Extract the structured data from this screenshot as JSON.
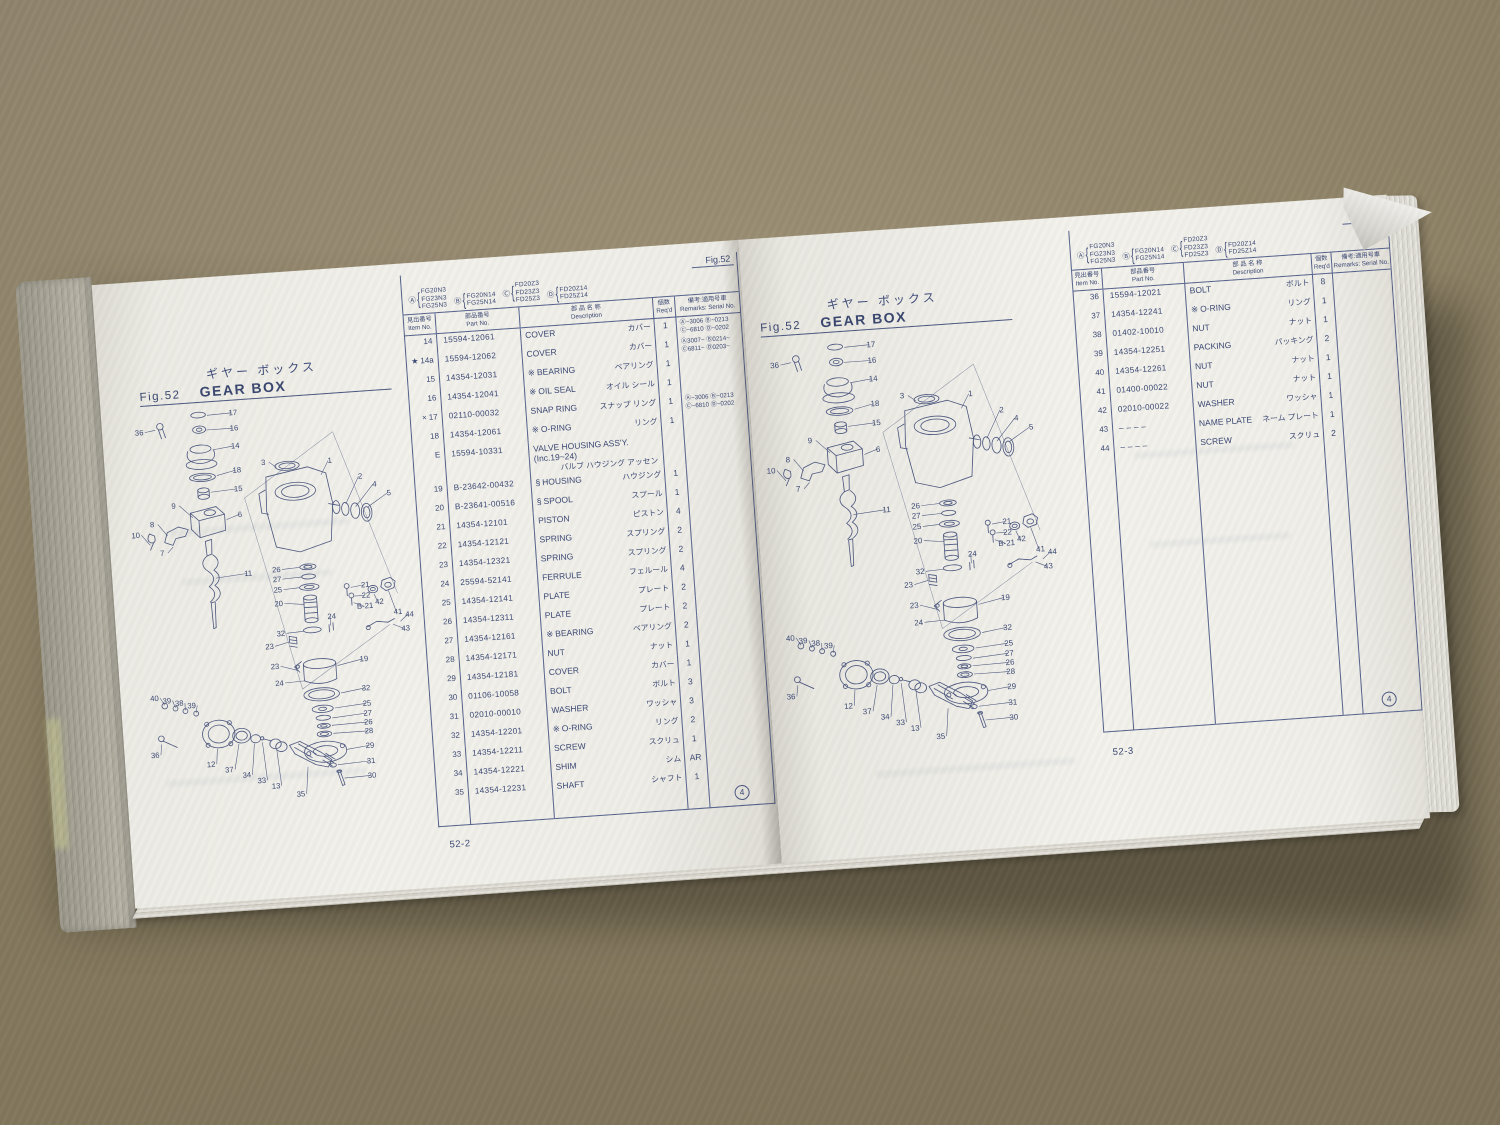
{
  "photo": {
    "surface": "cardboard",
    "cardboard_color": "#948769",
    "paper_color": "#f2f1eb",
    "ink_color": "#3b4874"
  },
  "left_page": {
    "title_jp": "ギヤー ボックス",
    "fig": "Fig.52",
    "title_en": "GEAR BOX",
    "footer": "52-2",
    "circle_mark": "4"
  },
  "right_page": {
    "title_jp": "ギヤー ボックス",
    "fig": "Fig.52",
    "title_en": "GEAR BOX",
    "footer": "52-3",
    "circle_mark": "4"
  },
  "table_header": {
    "fig_label": "Fig.52",
    "model_groups": [
      {
        "tag": "Ⓐ",
        "models": [
          "FG20N3",
          "FG23N3",
          "FG25N3"
        ]
      },
      {
        "tag": "Ⓑ",
        "models": [
          "FG20N14",
          "FG25N14"
        ]
      },
      {
        "tag": "Ⓒ",
        "models": [
          "FD20Z3",
          "FD23Z3",
          "FD25Z3"
        ]
      },
      {
        "tag": "Ⓓ",
        "models": [
          "FD20Z14",
          "FD25Z14"
        ]
      }
    ],
    "columns": [
      {
        "jp": "見出番号",
        "en": "Item No."
      },
      {
        "jp": "部品番号",
        "en": "Part No."
      },
      {
        "jp": "部 品 名 称",
        "en": "Description"
      },
      {
        "jp": "個数",
        "en": "Req'd"
      },
      {
        "jp": "備考:適用号車",
        "en": "Remarks: Serial No."
      }
    ]
  },
  "left_rows": [
    {
      "item": "14",
      "part": "15594-12061",
      "desc": "COVER",
      "kana": "カバー",
      "qty": "1",
      "rem": [
        "Ⓐ~3006 Ⓑ~0213",
        "Ⓒ~6810 Ⓓ~0202"
      ]
    },
    {
      "imark": "★",
      "item": "14a",
      "part": "15594-12062",
      "desc": "COVER",
      "kana": "カバー",
      "qty": "1",
      "rem": [
        "Ⓐ3007~ Ⓑ0214~",
        "Ⓒ6811~ Ⓓ0203~"
      ]
    },
    {
      "item": "15",
      "part": "14354-12031",
      "mark": "※",
      "desc": "BEARING",
      "kana": "ベアリング",
      "qty": "1"
    },
    {
      "item": "16",
      "part": "14354-12041",
      "mark": "※",
      "desc": "OIL SEAL",
      "kana": "オイル シール",
      "qty": "1"
    },
    {
      "imark": "×",
      "item": "17",
      "part": "02110-00032",
      "desc": "SNAP RING",
      "kana": "スナップ リング",
      "qty": "1",
      "rem": [
        "Ⓐ~3006 Ⓑ~0213",
        "Ⓒ~6810 Ⓓ~0202"
      ]
    },
    {
      "item": "18",
      "part": "14354-12061",
      "mark": "※",
      "desc": "O-RING",
      "kana": "リング",
      "qty": "1"
    },
    {
      "item": "E",
      "part": "15594-10331",
      "desc": "VALVE HOUSING ASS'Y.",
      "desc2": "(Inc.19~24)",
      "kana": "バルブ ハウジング アッセン",
      "kana_below": true,
      "qty": ""
    },
    {
      "item": "19",
      "part": "B-23642-00432",
      "mark": "§",
      "desc": "HOUSING",
      "kana": "ハウジング",
      "qty": "1"
    },
    {
      "item": "20",
      "part": "B-23641-00516",
      "mark": "§",
      "desc": "SPOOL",
      "kana": "スプール",
      "qty": "1"
    },
    {
      "item": "21",
      "part": "14354-12101",
      "desc": "PISTON",
      "kana": "ピストン",
      "qty": "4"
    },
    {
      "item": "22",
      "part": "14354-12121",
      "desc": "SPRING",
      "kana": "スプリング",
      "qty": "2"
    },
    {
      "item": "23",
      "part": "14354-12321",
      "desc": "SPRING",
      "kana": "スプリング",
      "qty": "2"
    },
    {
      "item": "24",
      "part": "25594-52141",
      "desc": "FERRULE",
      "kana": "フェルール",
      "qty": "4"
    },
    {
      "item": "25",
      "part": "14354-12141",
      "desc": "PLATE",
      "kana": "プレート",
      "qty": "2"
    },
    {
      "item": "26",
      "part": "14354-12311",
      "desc": "PLATE",
      "kana": "プレート",
      "qty": "2"
    },
    {
      "item": "27",
      "part": "14354-12161",
      "mark": "※",
      "desc": "BEARING",
      "kana": "ベアリング",
      "qty": "2"
    },
    {
      "item": "28",
      "part": "14354-12171",
      "desc": "NUT",
      "kana": "ナット",
      "qty": "1"
    },
    {
      "item": "29",
      "part": "14354-12181",
      "desc": "COVER",
      "kana": "カバー",
      "qty": "1"
    },
    {
      "item": "30",
      "part": "01106-10058",
      "desc": "BOLT",
      "kana": "ボルト",
      "qty": "3"
    },
    {
      "item": "31",
      "part": "02010-00010",
      "desc": "WASHER",
      "kana": "ワッシャ",
      "qty": "3"
    },
    {
      "item": "32",
      "part": "14354-12201",
      "mark": "※",
      "desc": "O-RING",
      "kana": "リング",
      "qty": "2"
    },
    {
      "item": "33",
      "part": "14354-12211",
      "desc": "SCREW",
      "kana": "スクリュ",
      "qty": "1"
    },
    {
      "item": "34",
      "part": "14354-12221",
      "desc": "SHIM",
      "kana": "シム",
      "qty": "AR"
    },
    {
      "item": "35",
      "part": "14354-12231",
      "desc": "SHAFT",
      "kana": "シャフト",
      "qty": "1"
    }
  ],
  "right_rows": [
    {
      "item": "36",
      "part": "15594-12021",
      "desc": "BOLT",
      "kana": "ボルト",
      "qty": "8"
    },
    {
      "item": "37",
      "part": "14354-12241",
      "mark": "※",
      "desc": "O-RING",
      "kana": "リング",
      "qty": "1"
    },
    {
      "item": "38",
      "part": "01402-10010",
      "desc": "NUT",
      "kana": "ナット",
      "qty": "1"
    },
    {
      "item": "39",
      "part": "14354-12251",
      "desc": "PACKING",
      "kana": "パッキング",
      "qty": "2"
    },
    {
      "item": "40",
      "part": "14354-12261",
      "desc": "NUT",
      "kana": "ナット",
      "qty": "1"
    },
    {
      "item": "41",
      "part": "01400-00022",
      "desc": "NUT",
      "kana": "ナット",
      "qty": "1"
    },
    {
      "item": "42",
      "part": "02010-00022",
      "desc": "WASHER",
      "kana": "ワッシャ",
      "qty": "1"
    },
    {
      "item": "43",
      "part": "– – – –",
      "desc": "NAME PLATE",
      "kana": "ネーム プレート",
      "qty": "1"
    },
    {
      "item": "44",
      "part": "– – – –",
      "desc": "SCREW",
      "kana": "スクリュ",
      "qty": "2"
    }
  ],
  "diagram_callouts": [
    {
      "t": "36",
      "x": 26,
      "y": 46,
      "ex": 46,
      "ey": 41
    },
    {
      "t": "17",
      "x": 143,
      "y": 29,
      "ex": 111,
      "ey": 27
    },
    {
      "t": "16",
      "x": 143,
      "y": 48,
      "ex": 109,
      "ey": 45
    },
    {
      "t": "14",
      "x": 143,
      "y": 70,
      "ex": 115,
      "ey": 70
    },
    {
      "t": "18",
      "x": 143,
      "y": 100,
      "ex": 118,
      "ey": 102
    },
    {
      "t": "15",
      "x": 143,
      "y": 123,
      "ex": 109,
      "ey": 122
    },
    {
      "t": "6",
      "x": 143,
      "y": 155,
      "ex": 126,
      "ey": 157
    },
    {
      "t": "9",
      "x": 62,
      "y": 139,
      "ex": 85,
      "ey": 152
    },
    {
      "t": "8",
      "x": 34,
      "y": 160,
      "ex": 52,
      "ey": 172
    },
    {
      "t": "10",
      "x": 13,
      "y": 172,
      "ex": 30,
      "ey": 182
    },
    {
      "t": "7",
      "x": 44,
      "y": 196,
      "ex": 58,
      "ey": 186
    },
    {
      "t": "11",
      "x": 148,
      "y": 228,
      "ex": 108,
      "ey": 228
    },
    {
      "t": "3",
      "x": 176,
      "y": 93,
      "ex": 192,
      "ey": 97
    },
    {
      "t": "1",
      "x": 258,
      "y": 96,
      "ex": 246,
      "ey": 110
    },
    {
      "t": "2",
      "x": 294,
      "y": 118,
      "ex": 274,
      "ey": 148
    },
    {
      "t": "4",
      "x": 311,
      "y": 129,
      "ex": 286,
      "ey": 152
    },
    {
      "t": "5",
      "x": 328,
      "y": 141,
      "ex": 300,
      "ey": 154
    },
    {
      "t": "26",
      "x": 183,
      "y": 226,
      "ex": 212,
      "ey": 222
    },
    {
      "t": "27",
      "x": 183,
      "y": 238,
      "ex": 214,
      "ey": 234
    },
    {
      "t": "25",
      "x": 183,
      "y": 251,
      "ex": 210,
      "ey": 247
    },
    {
      "t": "20",
      "x": 183,
      "y": 268,
      "ex": 214,
      "ey": 268
    },
    {
      "t": "32",
      "x": 183,
      "y": 305,
      "ex": 211,
      "ey": 301
    },
    {
      "t": "23",
      "x": 168,
      "y": 320,
      "ex": 192,
      "ey": 313
    },
    {
      "t": "24",
      "x": 247,
      "y": 288,
      "ex": 245,
      "ey": 296
    },
    {
      "t": "21",
      "x": 291,
      "y": 252,
      "ex": 273,
      "ey": 251
    },
    {
      "t": "22",
      "x": 291,
      "y": 265,
      "ex": 277,
      "ey": 262
    },
    {
      "t": "B-21",
      "x": 289,
      "y": 278,
      "ex": 275,
      "ey": 270
    },
    {
      "t": "42",
      "x": 307,
      "y": 274,
      "ex": 301,
      "ey": 261
    },
    {
      "t": "41",
      "x": 329,
      "y": 288,
      "ex": 319,
      "ey": 258
    },
    {
      "t": "44",
      "x": 343,
      "y": 292,
      "ex": 331,
      "ey": 297
    },
    {
      "t": "43",
      "x": 337,
      "y": 309,
      "ex": 322,
      "ey": 300
    },
    {
      "t": "23",
      "x": 173,
      "y": 345,
      "ex": 202,
      "ey": 349
    },
    {
      "t": "24",
      "x": 177,
      "y": 366,
      "ex": 208,
      "ey": 362
    },
    {
      "t": "19",
      "x": 283,
      "y": 343,
      "ex": 250,
      "ey": 346
    },
    {
      "t": "32",
      "x": 283,
      "y": 379,
      "ex": 252,
      "ey": 380
    },
    {
      "t": "25",
      "x": 283,
      "y": 398,
      "ex": 243,
      "ey": 398
    },
    {
      "t": "27",
      "x": 283,
      "y": 410,
      "ex": 239,
      "ey": 410
    },
    {
      "t": "26",
      "x": 283,
      "y": 421,
      "ex": 238,
      "ey": 419
    },
    {
      "t": "28",
      "x": 283,
      "y": 432,
      "ex": 239,
      "ey": 429
    },
    {
      "t": "29",
      "x": 283,
      "y": 450,
      "ex": 254,
      "ey": 450
    },
    {
      "t": "31",
      "x": 283,
      "y": 469,
      "ex": 242,
      "ey": 468
    },
    {
      "t": "30",
      "x": 283,
      "y": 487,
      "ex": 249,
      "ey": 485
    },
    {
      "t": "40",
      "x": 22,
      "y": 374,
      "ex": 34,
      "ey": 380
    },
    {
      "t": "39",
      "x": 37,
      "y": 378,
      "ex": 47,
      "ey": 384
    },
    {
      "t": "38",
      "x": 52,
      "y": 382,
      "ex": 59,
      "ey": 388
    },
    {
      "t": "39",
      "x": 67,
      "y": 386,
      "ex": 72,
      "ey": 392
    },
    {
      "t": "36",
      "x": 18,
      "y": 444,
      "ex": 27,
      "ey": 428
    },
    {
      "t": "12",
      "x": 86,
      "y": 460,
      "ex": 95,
      "ey": 438
    },
    {
      "t": "37",
      "x": 108,
      "y": 468,
      "ex": 122,
      "ey": 434
    },
    {
      "t": "34",
      "x": 129,
      "y": 476,
      "ex": 141,
      "ey": 435
    },
    {
      "t": "33",
      "x": 147,
      "y": 484,
      "ex": 151,
      "ey": 434
    },
    {
      "t": "13",
      "x": 164,
      "y": 492,
      "ex": 168,
      "ey": 444
    },
    {
      "t": "35",
      "x": 194,
      "y": 504,
      "ex": 205,
      "ey": 468
    }
  ]
}
